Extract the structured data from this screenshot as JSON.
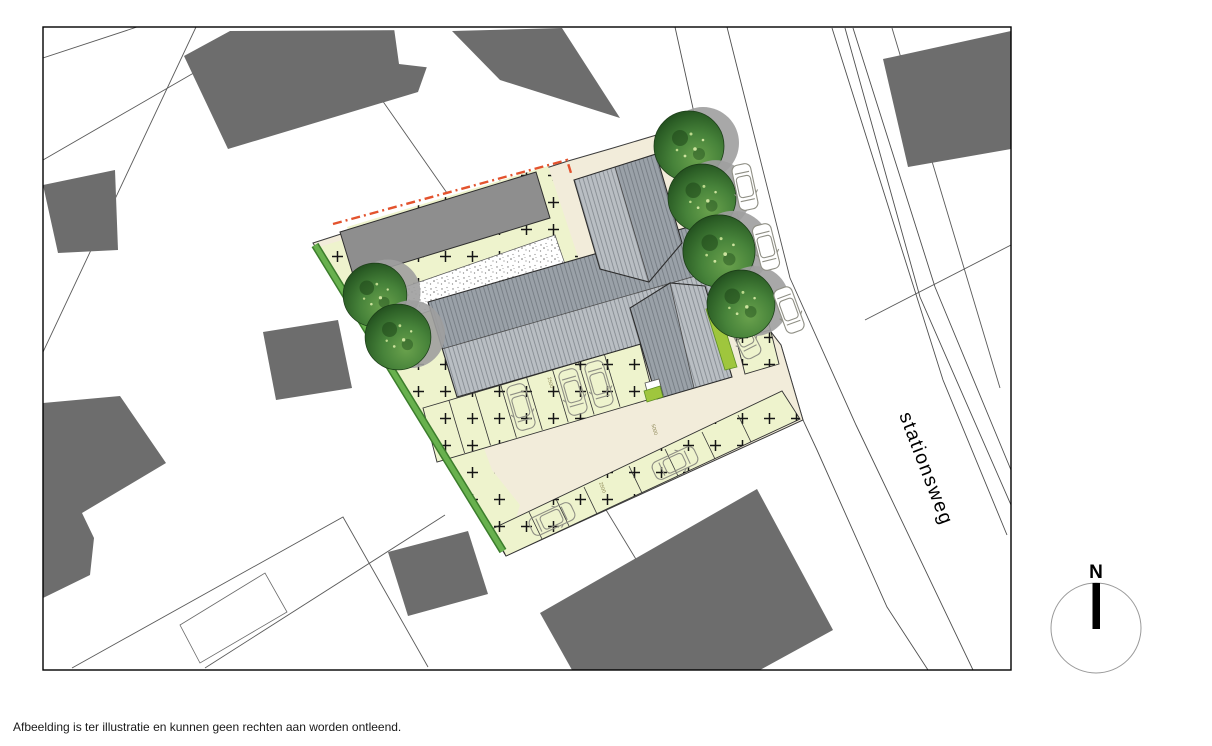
{
  "plan": {
    "caption": "Afbeelding is ter illustratie en kunnen geen rechten aan worden ontleend.",
    "road_label": "stationsweg",
    "compass": {
      "label": "N"
    },
    "dimension_labels": [
      "2500",
      "5000",
      "2500"
    ],
    "legend_colors": {
      "neighbor_building": "#6d6d6d",
      "new_building_roof_light": "#b9bec3",
      "new_building_roof_dark": "#9aa1a8",
      "barn_roof": "#8e8e8e",
      "paving": "#f2ecda",
      "garden": "#eef3cd",
      "hedge": "#4f9a3c",
      "tree": "#2f6527",
      "plot_boundary_dashed": "#e3532e"
    }
  }
}
